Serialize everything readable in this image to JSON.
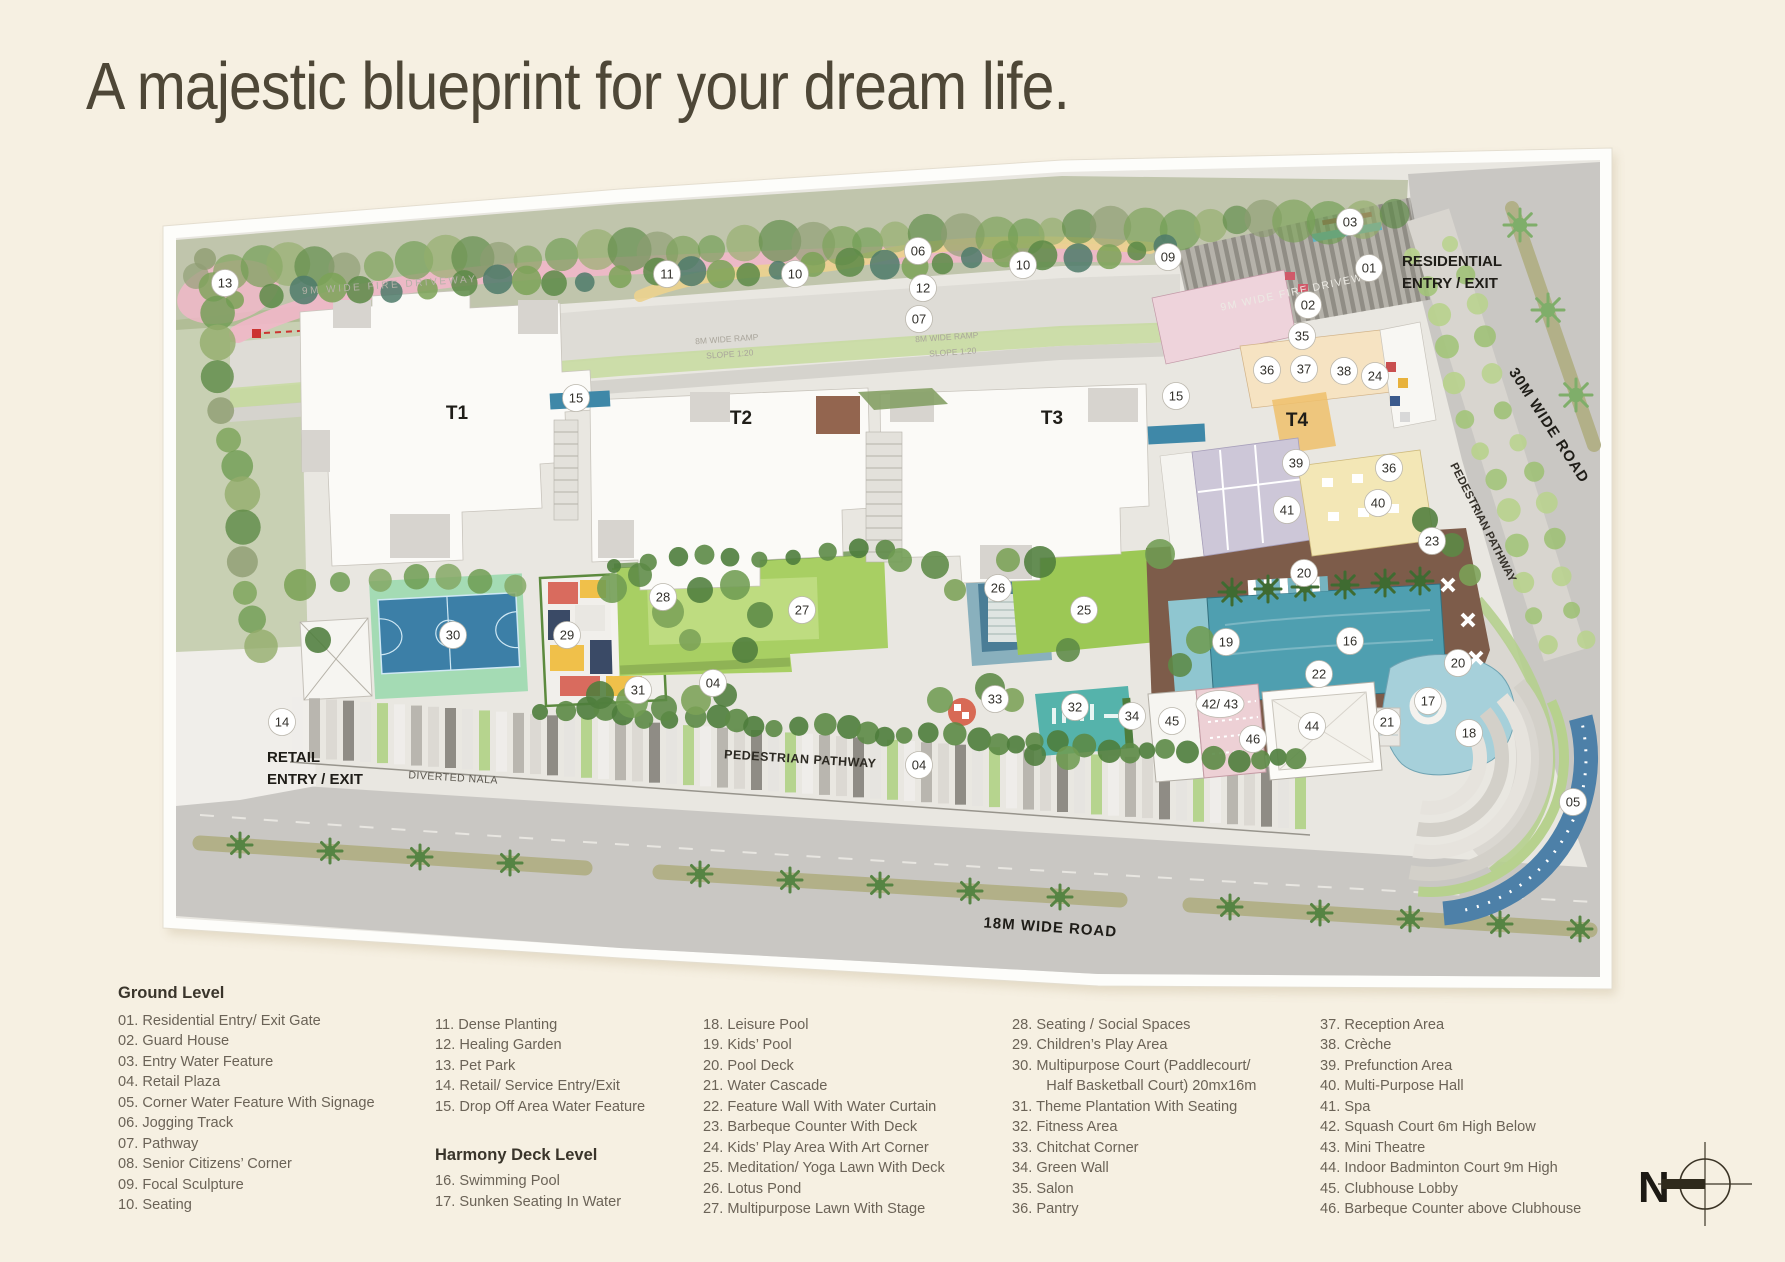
{
  "page": {
    "title": "A majestic blueprint for your dream life."
  },
  "palette": {
    "background": "#f6f0e2",
    "paper": "#fdfdfa",
    "site_base": "#e9e7e1",
    "road": "#c9c7c3",
    "median_olive": "#b2b088",
    "jogging_track_pink": "#f0b7c8",
    "lawn_green": "#a8cf63",
    "court_blue": "#3c7fa7",
    "court_surround": "#a4dbb4",
    "pool_teal": "#4f9fb0",
    "leisure_pool": "#a6d0da",
    "deck_brown": "#7d5c4a",
    "hall_yellow": "#f3e7b6",
    "spa_lavender": "#cdc7d8",
    "squash_pink": "#edd0d5"
  },
  "plan": {
    "labels": {
      "residential_entry_line1": "RESIDENTIAL",
      "residential_entry_line2": "ENTRY / EXIT",
      "retail_entry_line1": "RETAIL",
      "retail_entry_line2": "ENTRY / EXIT",
      "road_30m": "30M WIDE ROAD",
      "road_18m": "18M WIDE ROAD",
      "pedestrian_pathway_right": "PEDESTRIAN PATHWAY",
      "pedestrian_pathway_bottom": "PEDESTRIAN PATHWAY",
      "diverted_nala": "DIVERTED NALA",
      "fire_driveway_left": "9M WIDE FIRE DRIVEWAY",
      "fire_driveway_right": "9M WIDE FIRE DRIVEWAY",
      "ramp_left": "8M WIDE RAMP",
      "ramp_right": "8M WIDE RAMP",
      "slope_left": "SLOPE 1:20",
      "slope_right": "SLOPE 1:20",
      "north": "N"
    },
    "towers": [
      {
        "label": "T1",
        "x": 457,
        "y": 419
      },
      {
        "label": "T2",
        "x": 741,
        "y": 424
      },
      {
        "label": "T3",
        "x": 1052,
        "y": 424
      },
      {
        "label": "T4",
        "x": 1297,
        "y": 426
      }
    ],
    "markers": [
      {
        "label": "01",
        "x": 1369,
        "y": 268
      },
      {
        "label": "02",
        "x": 1308,
        "y": 305
      },
      {
        "label": "03",
        "x": 1350,
        "y": 222
      },
      {
        "label": "04",
        "x": 713,
        "y": 683
      },
      {
        "label": "04",
        "x": 919,
        "y": 765
      },
      {
        "label": "05",
        "x": 1573,
        "y": 802
      },
      {
        "label": "06",
        "x": 918,
        "y": 251
      },
      {
        "label": "07",
        "x": 919,
        "y": 319
      },
      {
        "label": "09",
        "x": 1168,
        "y": 257
      },
      {
        "label": "10",
        "x": 795,
        "y": 274
      },
      {
        "label": "10",
        "x": 1023,
        "y": 265
      },
      {
        "label": "11",
        "x": 667,
        "y": 274
      },
      {
        "label": "12",
        "x": 923,
        "y": 288
      },
      {
        "label": "13",
        "x": 225,
        "y": 283
      },
      {
        "label": "14",
        "x": 282,
        "y": 722
      },
      {
        "label": "15",
        "x": 576,
        "y": 398
      },
      {
        "label": "15",
        "x": 1176,
        "y": 396
      },
      {
        "label": "16",
        "x": 1350,
        "y": 641
      },
      {
        "label": "17",
        "x": 1428,
        "y": 701
      },
      {
        "label": "18",
        "x": 1469,
        "y": 733
      },
      {
        "label": "19",
        "x": 1226,
        "y": 642
      },
      {
        "label": "20",
        "x": 1304,
        "y": 573
      },
      {
        "label": "20",
        "x": 1458,
        "y": 663
      },
      {
        "label": "21",
        "x": 1387,
        "y": 722
      },
      {
        "label": "22",
        "x": 1319,
        "y": 674
      },
      {
        "label": "23",
        "x": 1432,
        "y": 541
      },
      {
        "label": "24",
        "x": 1375,
        "y": 376
      },
      {
        "label": "25",
        "x": 1084,
        "y": 610
      },
      {
        "label": "26",
        "x": 998,
        "y": 588
      },
      {
        "label": "27",
        "x": 802,
        "y": 610
      },
      {
        "label": "28",
        "x": 663,
        "y": 597
      },
      {
        "label": "29",
        "x": 567,
        "y": 635
      },
      {
        "label": "30",
        "x": 453,
        "y": 635
      },
      {
        "label": "31",
        "x": 638,
        "y": 690
      },
      {
        "label": "32",
        "x": 1075,
        "y": 707
      },
      {
        "label": "33",
        "x": 995,
        "y": 699
      },
      {
        "label": "34",
        "x": 1132,
        "y": 716
      },
      {
        "label": "35",
        "x": 1302,
        "y": 336
      },
      {
        "label": "36",
        "x": 1267,
        "y": 370
      },
      {
        "label": "36",
        "x": 1389,
        "y": 468
      },
      {
        "label": "37",
        "x": 1304,
        "y": 369
      },
      {
        "label": "38",
        "x": 1344,
        "y": 371
      },
      {
        "label": "39",
        "x": 1296,
        "y": 463
      },
      {
        "label": "40",
        "x": 1378,
        "y": 503
      },
      {
        "label": "41",
        "x": 1287,
        "y": 510
      },
      {
        "label": "42/ 43",
        "x": 1220,
        "y": 704
      },
      {
        "label": "44",
        "x": 1312,
        "y": 726
      },
      {
        "label": "45",
        "x": 1172,
        "y": 721
      },
      {
        "label": "46",
        "x": 1253,
        "y": 739
      }
    ]
  },
  "legend": {
    "columns": [
      {
        "x": 118,
        "w": 300,
        "header": "Ground Level",
        "items": [
          "01. Residential Entry/ Exit Gate",
          "02. Guard House",
          "03. Entry Water Feature",
          "04. Retail Plaza",
          "05. Corner Water Feature With Signage",
          "06. Jogging Track",
          "07. Pathway",
          "08. Senior Citizens’ Corner",
          "09. Focal Sculpture",
          "10. Seating"
        ]
      },
      {
        "x": 435,
        "w": 270,
        "items": [
          "11. Dense Planting",
          "12. Healing Garden",
          "13. Pet Park",
          "14. Retail/ Service Entry/Exit",
          "15. Drop Off Area Water Feature"
        ],
        "subheader": "Harmony Deck Level",
        "subitems": [
          "16. Swimming Pool",
          "17. Sunken Seating In Water"
        ]
      },
      {
        "x": 703,
        "w": 300,
        "items": [
          "18. Leisure Pool",
          "19. Kids’ Pool",
          "20. Pool Deck",
          "21. Water Cascade",
          "22. Feature Wall With Water Curtain",
          "23. Barbeque Counter With Deck",
          "24. Kids’ Play Area With Art Corner",
          "25. Meditation/ Yoga Lawn With Deck",
          "26. Lotus Pond",
          "27. Multipurpose Lawn With Stage"
        ]
      },
      {
        "x": 1012,
        "w": 300,
        "items": [
          "28. Seating / Social Spaces",
          "29. Children’s Play Area",
          "30. Multipurpose Court (Paddlecourt/\nHalf Basketball Court) 20mx16m",
          "31. Theme Plantation With Seating",
          "32. Fitness Area",
          "33. Chitchat Corner",
          "34. Green Wall",
          "35. Salon",
          "36. Pantry"
        ]
      },
      {
        "x": 1320,
        "w": 330,
        "items": [
          "37. Reception Area",
          "38. Crèche",
          "39. Prefunction Area",
          "40. Multi-Purpose Hall",
          "41. Spa",
          "42. Squash Court 6m High Below",
          "43. Mini Theatre",
          "44. Indoor Badminton Court 9m High",
          "45. Clubhouse Lobby",
          "46. Barbeque Counter above Clubhouse"
        ]
      }
    ]
  }
}
